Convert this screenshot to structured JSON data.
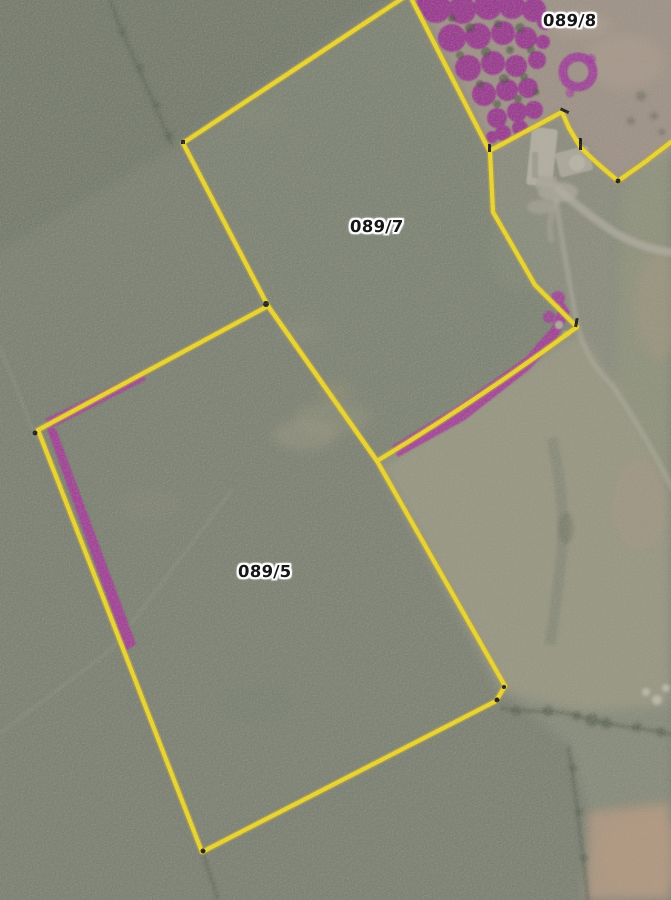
{
  "map": {
    "kind": "scanned aerial photograph with parcel boundary overlay",
    "labels": [
      {
        "text": "089/8"
      },
      {
        "text": "089/7"
      },
      {
        "text": "089/5"
      }
    ],
    "colors": {
      "boundary_yellow": "#f4df25",
      "overlay_magenta": "#aa34a0",
      "woodland_magenta": "#9c2c95",
      "label_ink": "#161616",
      "label_halo": "#ffffff"
    }
  }
}
